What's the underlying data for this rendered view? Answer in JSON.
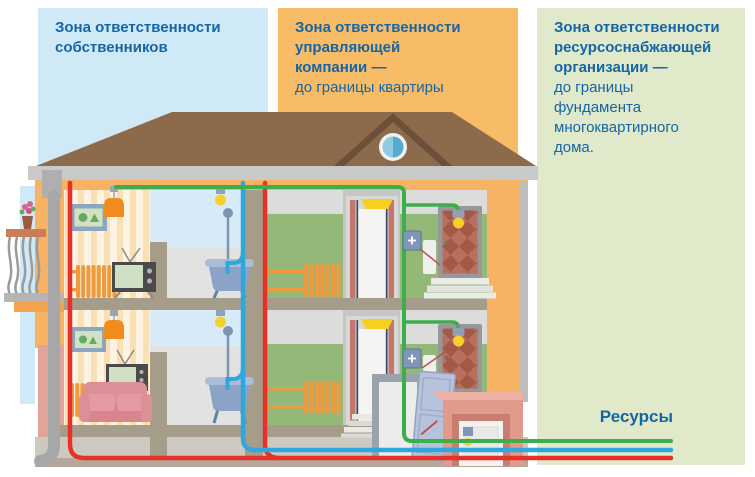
{
  "zones": [
    {
      "id": "owners",
      "title_bold": "Зона ответственности\nсобственников",
      "title_rest": ""
    },
    {
      "id": "management-company",
      "title_bold": "Зона ответственности\nуправляющей\nкомпании —",
      "title_rest": "до границы квартиры"
    },
    {
      "id": "resource-supplier",
      "title_bold": "Зона ответственности\nресурсоснабжающей\nорганизации —",
      "title_rest": "до границы\nфундамента\nмногоквартирного\nдома."
    }
  ],
  "resources": {
    "label": "Ресурсы"
  },
  "colors": {
    "heading": "#1566a6",
    "zone1-bg": "#cfe9f7",
    "zone2-bg": "#f8bc66",
    "zone3-bg": "#e0e9c9",
    "electricity": "#3cae4c",
    "water": "#2fa7dc",
    "heating": "#e63128",
    "radiator": "#f0953f",
    "facade": "#f8b264",
    "roof": "#8c6a4c"
  }
}
